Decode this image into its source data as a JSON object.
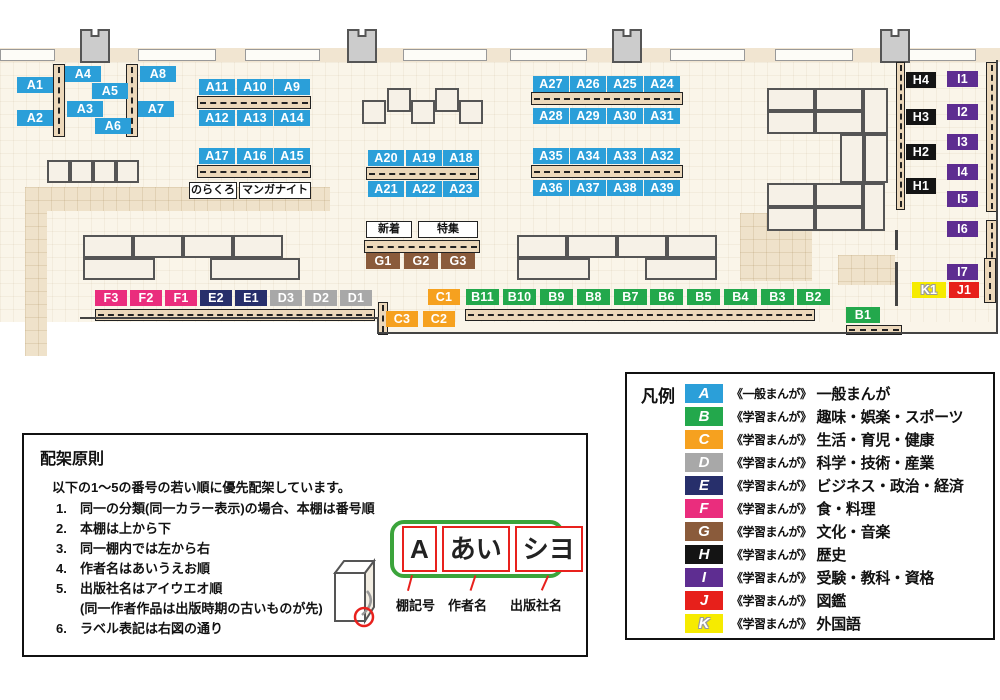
{
  "groups": {
    "A": {
      "color": "#2b9fd9"
    },
    "B": {
      "color": "#23a84c"
    },
    "C": {
      "color": "#f6a11f"
    },
    "D": {
      "color": "#a8a8a8"
    },
    "E": {
      "color": "#272f6b"
    },
    "F": {
      "color": "#ea2d7d"
    },
    "G": {
      "color": "#8a5b3b"
    },
    "H": {
      "color": "#141414"
    },
    "I": {
      "color": "#5e2d91"
    },
    "J": {
      "color": "#e7201b"
    },
    "K": {
      "color": "#f6eb00",
      "outline": true
    }
  },
  "map": {
    "band": [
      0,
      48,
      1000,
      14
    ],
    "windows": [
      [
        0,
        49,
        55,
        12
      ],
      [
        138,
        49,
        78,
        12
      ],
      [
        245,
        49,
        75,
        12
      ],
      [
        403,
        49,
        84,
        12
      ],
      [
        510,
        49,
        77,
        12
      ],
      [
        670,
        49,
        75,
        12
      ],
      [
        775,
        49,
        78,
        12
      ],
      [
        908,
        49,
        68,
        12
      ]
    ],
    "pillars": [
      [
        80,
        29
      ],
      [
        347,
        29
      ],
      [
        612,
        29
      ],
      [
        880,
        29
      ]
    ],
    "paths": [
      [
        25,
        187,
        305,
        24
      ],
      [
        25,
        187,
        22,
        169
      ],
      [
        740,
        213,
        72,
        68
      ],
      [
        838,
        255,
        57,
        30
      ]
    ],
    "walls": [
      [
        80,
        317,
        298,
        2
      ],
      [
        377,
        317,
        2,
        17
      ],
      [
        377,
        332,
        621,
        2
      ],
      [
        895,
        230,
        3,
        20
      ],
      [
        895,
        262,
        3,
        44
      ],
      [
        996,
        60,
        2,
        274
      ]
    ],
    "tables": [
      [
        362,
        100,
        24,
        24
      ],
      [
        387,
        88,
        24,
        24
      ],
      [
        411,
        100,
        24,
        24
      ],
      [
        435,
        88,
        24,
        24
      ],
      [
        459,
        100,
        24,
        24
      ],
      [
        47,
        160,
        23,
        23
      ],
      [
        70,
        160,
        23,
        23
      ],
      [
        93,
        160,
        23,
        23
      ],
      [
        116,
        160,
        23,
        23
      ],
      [
        83,
        235,
        50,
        23
      ],
      [
        133,
        235,
        50,
        23
      ],
      [
        183,
        235,
        50,
        23
      ],
      [
        233,
        235,
        50,
        23
      ],
      [
        83,
        258,
        72,
        22
      ],
      [
        210,
        258,
        90,
        22
      ],
      [
        517,
        235,
        50,
        23
      ],
      [
        567,
        235,
        50,
        23
      ],
      [
        617,
        235,
        50,
        23
      ],
      [
        667,
        235,
        50,
        23
      ],
      [
        517,
        258,
        73,
        22
      ],
      [
        645,
        258,
        72,
        22
      ],
      [
        767,
        88,
        48,
        23
      ],
      [
        815,
        88,
        48,
        23
      ],
      [
        767,
        111,
        48,
        23
      ],
      [
        815,
        111,
        48,
        23
      ],
      [
        863,
        88,
        25,
        46
      ],
      [
        840,
        134,
        24,
        49
      ],
      [
        864,
        134,
        24,
        49
      ],
      [
        767,
        183,
        48,
        24
      ],
      [
        815,
        183,
        48,
        24
      ],
      [
        767,
        207,
        48,
        24
      ],
      [
        815,
        207,
        48,
        24
      ],
      [
        863,
        183,
        22,
        48
      ]
    ],
    "strips": [
      [
        53,
        64,
        12,
        73,
        "v"
      ],
      [
        126,
        64,
        12,
        73,
        "v"
      ],
      [
        197,
        96,
        114,
        13,
        "h"
      ],
      [
        197,
        165,
        114,
        13,
        "h"
      ],
      [
        366,
        167,
        113,
        13,
        "h"
      ],
      [
        531,
        92,
        152,
        13,
        "h"
      ],
      [
        531,
        165,
        152,
        13,
        "h"
      ],
      [
        364,
        240,
        116,
        13,
        "h"
      ],
      [
        95,
        309,
        280,
        12,
        "h"
      ],
      [
        465,
        309,
        350,
        12,
        "h"
      ],
      [
        378,
        302,
        10,
        33,
        "v"
      ],
      [
        846,
        325,
        56,
        10,
        "h"
      ],
      [
        896,
        62,
        9,
        148,
        "v"
      ],
      [
        986,
        62,
        11,
        150,
        "v"
      ],
      [
        986,
        220,
        11,
        50,
        "v"
      ],
      [
        984,
        258,
        12,
        45,
        "v"
      ]
    ],
    "shelves": [
      {
        "id": "A1",
        "g": "A",
        "x": 17,
        "y": 77
      },
      {
        "id": "A2",
        "g": "A",
        "x": 17,
        "y": 110
      },
      {
        "id": "A4",
        "g": "A",
        "x": 65,
        "y": 66
      },
      {
        "id": "A5",
        "g": "A",
        "x": 92,
        "y": 83
      },
      {
        "id": "A3",
        "g": "A",
        "x": 67,
        "y": 101
      },
      {
        "id": "A6",
        "g": "A",
        "x": 95,
        "y": 118
      },
      {
        "id": "A8",
        "g": "A",
        "x": 140,
        "y": 66
      },
      {
        "id": "A7",
        "g": "A",
        "x": 138,
        "y": 101
      },
      {
        "id": "A11",
        "g": "A",
        "x": 199,
        "y": 79
      },
      {
        "id": "A10",
        "g": "A",
        "x": 237,
        "y": 79
      },
      {
        "id": "A9",
        "g": "A",
        "x": 274,
        "y": 79
      },
      {
        "id": "A12",
        "g": "A",
        "x": 199,
        "y": 110
      },
      {
        "id": "A13",
        "g": "A",
        "x": 237,
        "y": 110
      },
      {
        "id": "A14",
        "g": "A",
        "x": 274,
        "y": 110
      },
      {
        "id": "A17",
        "g": "A",
        "x": 199,
        "y": 148
      },
      {
        "id": "A16",
        "g": "A",
        "x": 237,
        "y": 148
      },
      {
        "id": "A15",
        "g": "A",
        "x": 274,
        "y": 148
      },
      {
        "id": "A20",
        "g": "A",
        "x": 368,
        "y": 150
      },
      {
        "id": "A19",
        "g": "A",
        "x": 406,
        "y": 150
      },
      {
        "id": "A18",
        "g": "A",
        "x": 443,
        "y": 150
      },
      {
        "id": "A21",
        "g": "A",
        "x": 368,
        "y": 181
      },
      {
        "id": "A22",
        "g": "A",
        "x": 406,
        "y": 181
      },
      {
        "id": "A23",
        "g": "A",
        "x": 443,
        "y": 181
      },
      {
        "id": "A27",
        "g": "A",
        "x": 533,
        "y": 76
      },
      {
        "id": "A26",
        "g": "A",
        "x": 570,
        "y": 76
      },
      {
        "id": "A25",
        "g": "A",
        "x": 607,
        "y": 76
      },
      {
        "id": "A24",
        "g": "A",
        "x": 644,
        "y": 76
      },
      {
        "id": "A28",
        "g": "A",
        "x": 533,
        "y": 108
      },
      {
        "id": "A29",
        "g": "A",
        "x": 570,
        "y": 108
      },
      {
        "id": "A30",
        "g": "A",
        "x": 607,
        "y": 108
      },
      {
        "id": "A31",
        "g": "A",
        "x": 644,
        "y": 108
      },
      {
        "id": "A35",
        "g": "A",
        "x": 533,
        "y": 148
      },
      {
        "id": "A34",
        "g": "A",
        "x": 570,
        "y": 148
      },
      {
        "id": "A33",
        "g": "A",
        "x": 607,
        "y": 148
      },
      {
        "id": "A32",
        "g": "A",
        "x": 644,
        "y": 148
      },
      {
        "id": "A36",
        "g": "A",
        "x": 533,
        "y": 180
      },
      {
        "id": "A37",
        "g": "A",
        "x": 570,
        "y": 180
      },
      {
        "id": "A38",
        "g": "A",
        "x": 607,
        "y": 180
      },
      {
        "id": "A39",
        "g": "A",
        "x": 644,
        "y": 180
      },
      {
        "id": "G1",
        "g": "G",
        "x": 366,
        "y": 253,
        "w": 34
      },
      {
        "id": "G2",
        "g": "G",
        "x": 404,
        "y": 253,
        "w": 34
      },
      {
        "id": "G3",
        "g": "G",
        "x": 441,
        "y": 253,
        "w": 34
      },
      {
        "id": "F3",
        "g": "F",
        "x": 95,
        "y": 290,
        "w": 32
      },
      {
        "id": "F2",
        "g": "F",
        "x": 130,
        "y": 290,
        "w": 32
      },
      {
        "id": "F1",
        "g": "F",
        "x": 165,
        "y": 290,
        "w": 32
      },
      {
        "id": "E2",
        "g": "E",
        "x": 200,
        "y": 290,
        "w": 32
      },
      {
        "id": "E1",
        "g": "E",
        "x": 235,
        "y": 290,
        "w": 32
      },
      {
        "id": "D3",
        "g": "D",
        "x": 270,
        "y": 290,
        "w": 32
      },
      {
        "id": "D2",
        "g": "D",
        "x": 305,
        "y": 290,
        "w": 32
      },
      {
        "id": "D1",
        "g": "D",
        "x": 340,
        "y": 290,
        "w": 32
      },
      {
        "id": "C1",
        "g": "C",
        "x": 428,
        "y": 289,
        "w": 32
      },
      {
        "id": "B11",
        "g": "B",
        "x": 466,
        "y": 289,
        "w": 33
      },
      {
        "id": "B10",
        "g": "B",
        "x": 503,
        "y": 289,
        "w": 33
      },
      {
        "id": "B9",
        "g": "B",
        "x": 540,
        "y": 289,
        "w": 33
      },
      {
        "id": "B8",
        "g": "B",
        "x": 577,
        "y": 289,
        "w": 33
      },
      {
        "id": "B7",
        "g": "B",
        "x": 614,
        "y": 289,
        "w": 33
      },
      {
        "id": "B6",
        "g": "B",
        "x": 650,
        "y": 289,
        "w": 33
      },
      {
        "id": "B5",
        "g": "B",
        "x": 687,
        "y": 289,
        "w": 33
      },
      {
        "id": "B4",
        "g": "B",
        "x": 724,
        "y": 289,
        "w": 33
      },
      {
        "id": "B3",
        "g": "B",
        "x": 761,
        "y": 289,
        "w": 33
      },
      {
        "id": "B2",
        "g": "B",
        "x": 797,
        "y": 289,
        "w": 33
      },
      {
        "id": "C3",
        "g": "C",
        "x": 386,
        "y": 311,
        "w": 32
      },
      {
        "id": "C2",
        "g": "C",
        "x": 423,
        "y": 311,
        "w": 32
      },
      {
        "id": "B1",
        "g": "B",
        "x": 846,
        "y": 307,
        "w": 34
      },
      {
        "id": "H4",
        "g": "H",
        "x": 906,
        "y": 72,
        "w": 30
      },
      {
        "id": "H3",
        "g": "H",
        "x": 906,
        "y": 109,
        "w": 30
      },
      {
        "id": "H2",
        "g": "H",
        "x": 906,
        "y": 144,
        "w": 30
      },
      {
        "id": "H1",
        "g": "H",
        "x": 906,
        "y": 178,
        "w": 30
      },
      {
        "id": "I1",
        "g": "I",
        "x": 947,
        "y": 71,
        "w": 31
      },
      {
        "id": "I2",
        "g": "I",
        "x": 947,
        "y": 104,
        "w": 31
      },
      {
        "id": "I3",
        "g": "I",
        "x": 947,
        "y": 134,
        "w": 31
      },
      {
        "id": "I4",
        "g": "I",
        "x": 947,
        "y": 164,
        "w": 31
      },
      {
        "id": "I5",
        "g": "I",
        "x": 947,
        "y": 191,
        "w": 31
      },
      {
        "id": "I6",
        "g": "I",
        "x": 947,
        "y": 221,
        "w": 31
      },
      {
        "id": "I7",
        "g": "I",
        "x": 947,
        "y": 264,
        "w": 31
      },
      {
        "id": "K1",
        "g": "K",
        "x": 912,
        "y": 282,
        "w": 34
      },
      {
        "id": "J1",
        "g": "J",
        "x": 949,
        "y": 282,
        "w": 30
      }
    ],
    "info_boxes": [
      {
        "text": "のらくろ",
        "x": 189,
        "y": 182,
        "w": 48
      },
      {
        "text": "マンガナイト",
        "x": 239,
        "y": 182,
        "w": 72
      },
      {
        "text": "新着",
        "x": 366,
        "y": 221,
        "w": 46
      },
      {
        "text": "特集",
        "x": 418,
        "y": 221,
        "w": 60
      }
    ]
  },
  "legend": {
    "title": "凡例",
    "items": [
      {
        "letter": "A",
        "series": "《一般まんが》",
        "category": "一般まんが"
      },
      {
        "letter": "B",
        "series": "《学習まんが》",
        "category": "趣味・娯楽・スポーツ"
      },
      {
        "letter": "C",
        "series": "《学習まんが》",
        "category": "生活・育児・健康"
      },
      {
        "letter": "D",
        "series": "《学習まんが》",
        "category": "科学・技術・産業"
      },
      {
        "letter": "E",
        "series": "《学習まんが》",
        "category": "ビジネス・政治・経済"
      },
      {
        "letter": "F",
        "series": "《学習まんが》",
        "category": "食・料理"
      },
      {
        "letter": "G",
        "series": "《学習まんが》",
        "category": "文化・音楽"
      },
      {
        "letter": "H",
        "series": "《学習まんが》",
        "category": "歴史"
      },
      {
        "letter": "I",
        "series": "《学習まんが》",
        "category": "受験・教科・資格"
      },
      {
        "letter": "J",
        "series": "《学習まんが》",
        "category": "図鑑"
      },
      {
        "letter": "K",
        "series": "《学習まんが》",
        "category": "外国語"
      }
    ]
  },
  "principles": {
    "title": "配架原則",
    "intro": "以下の1〜5の番号の若い順に優先配架しています。",
    "items": [
      {
        "n": "1.",
        "t": "同一の分類(同一カラー表示)の場合、本棚は番号順"
      },
      {
        "n": "2.",
        "t": "本棚は上から下"
      },
      {
        "n": "3.",
        "t": "同一棚内では左から右"
      },
      {
        "n": "4.",
        "t": "作者名はあいうえお順"
      },
      {
        "n": "5.",
        "t": "出版社名はアイウエオ順"
      },
      {
        "n": "",
        "t": "(同一作者作品は出版時期の古いものが先)"
      },
      {
        "n": "6.",
        "t": "ラベル表記は右図の通り"
      }
    ]
  },
  "label_diagram": {
    "segments": [
      "A",
      "あい",
      "シヨ"
    ],
    "captions": [
      "棚記号",
      "作者名",
      "出版社名"
    ]
  }
}
